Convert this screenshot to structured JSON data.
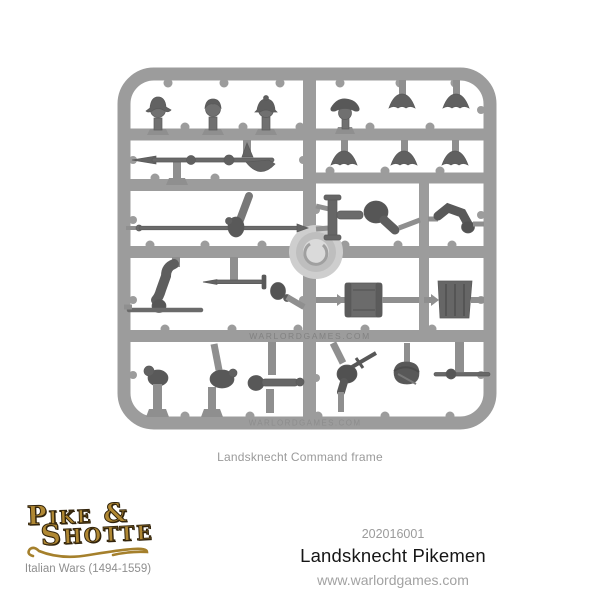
{
  "image": {
    "caption": "Landsknecht Command frame",
    "sprue": {
      "embossed_text": "WARLORDGAMES.COM",
      "plastic_color": "#9c9c9c",
      "part_color": "#707070",
      "parts": [
        "morion-helmet-head",
        "bare-head",
        "helmet-head",
        "beret-head",
        "feathered-hat",
        "feathered-hat",
        "feathered-hat",
        "feathered-hat",
        "feathered-hat",
        "halberd",
        "pike-with-hand",
        "bent-arm-with-pike-section",
        "sword-with-hand",
        "bugle-with-arm",
        "arm",
        "drum",
        "fluted-drum",
        "fist",
        "hand",
        "trumpet",
        "arm-with-dagger",
        "pouch",
        "staff-with-hand"
      ]
    }
  },
  "footer": {
    "logo": {
      "line1": "Pike &",
      "line2": "Shotte",
      "tagline": "Italian Wars (1494-1559)",
      "gold": "#b08833",
      "outline": "#32240c"
    },
    "product_code": "202016001",
    "product_title": "Landsknecht Pikemen",
    "website": "www.warlordgames.com"
  }
}
